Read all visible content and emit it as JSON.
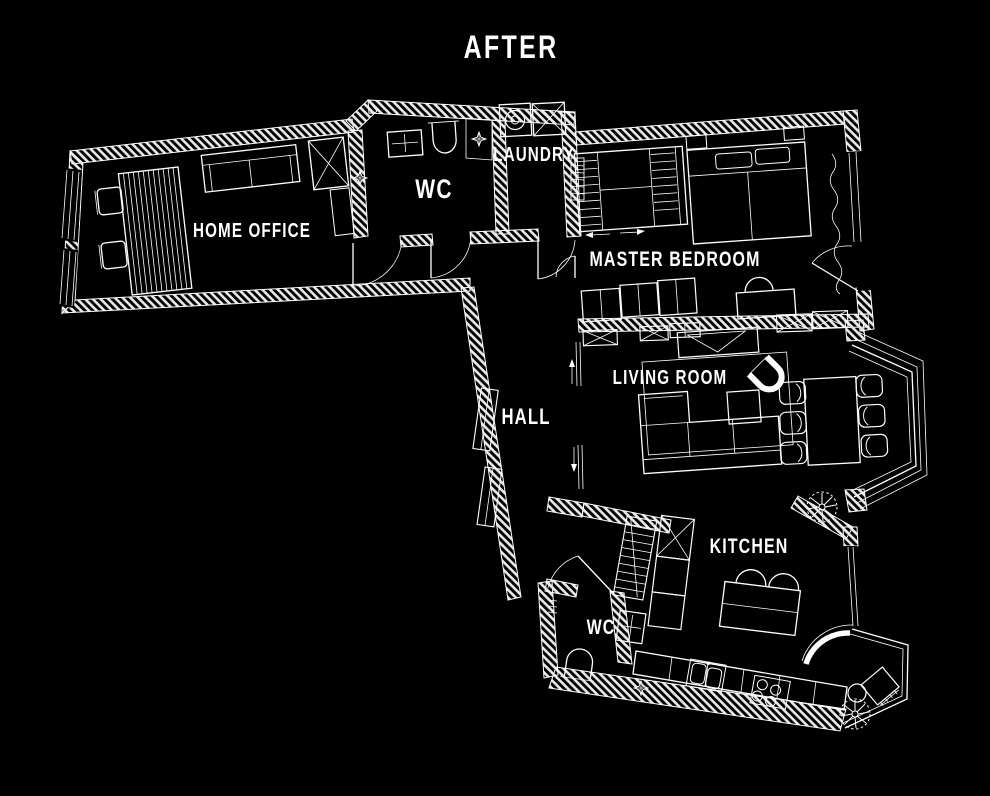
{
  "title": "AFTER",
  "colors": {
    "background": "#000000",
    "line": "#ffffff"
  },
  "rooms": [
    {
      "id": "home-office",
      "label": "HOME OFFICE"
    },
    {
      "id": "wc-top",
      "label": "WC"
    },
    {
      "id": "laundry",
      "label": "LAUNDRY"
    },
    {
      "id": "master-bedroom",
      "label": "MASTER BEDROOM"
    },
    {
      "id": "hall",
      "label": "HALL"
    },
    {
      "id": "living-room",
      "label": "LIVING ROOM"
    },
    {
      "id": "kitchen",
      "label": "KITCHEN"
    },
    {
      "id": "wc-bottom",
      "label": "WC"
    }
  ],
  "symbols": [
    "desk",
    "office-chair",
    "sofa",
    "wardrobe-x",
    "washing-machine",
    "toilet",
    "sink",
    "shower-drain",
    "bed",
    "sliding-wardrobe",
    "curtain-window",
    "dining-table",
    "chair",
    "armchair",
    "coffee-table",
    "tv-unit",
    "rug",
    "kitchen-island",
    "stool",
    "cooktop",
    "counter-sink",
    "ladder",
    "plant",
    "door-swing",
    "pocket-door",
    "window",
    "radiator",
    "bay-window",
    "balcony-table",
    "balcony-chair"
  ]
}
